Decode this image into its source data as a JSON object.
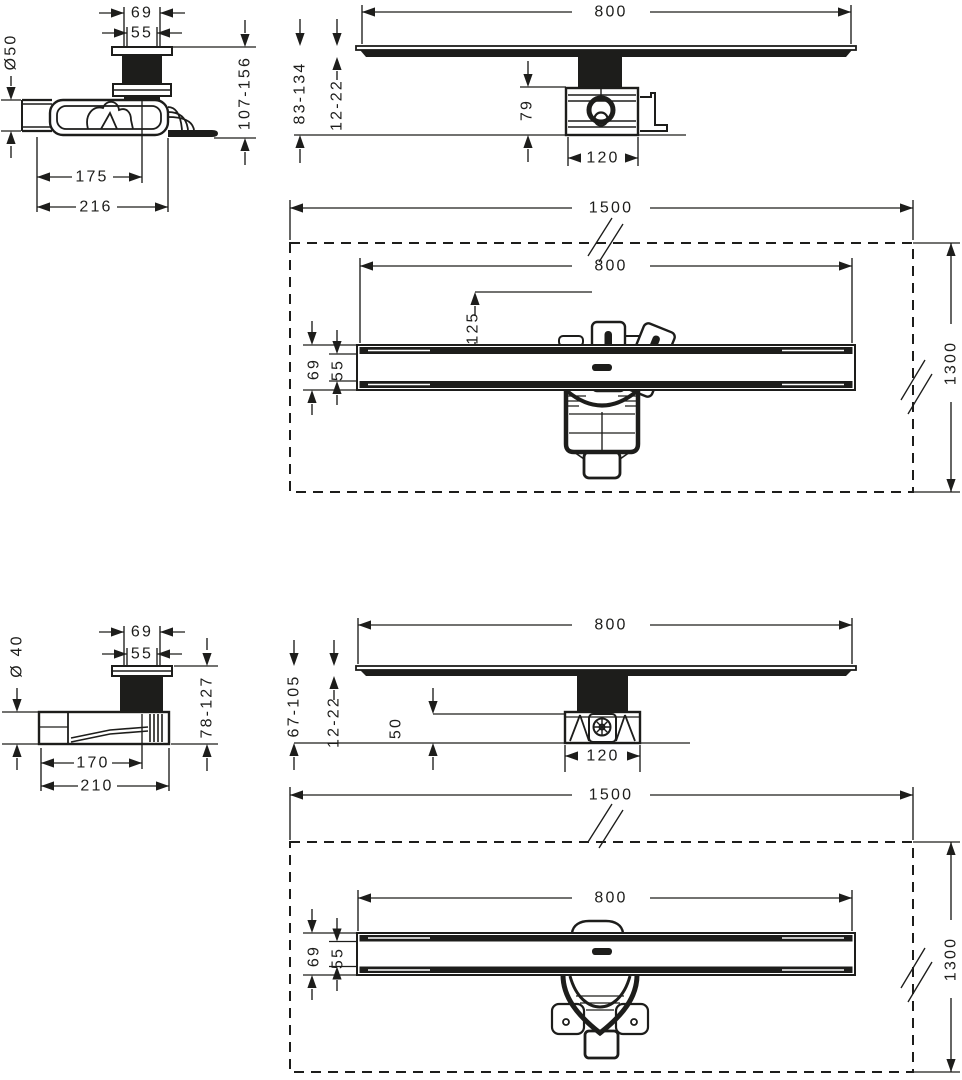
{
  "drawing": {
    "background": "#ffffff",
    "line_color": "#1d1d1b",
    "views": {
      "v1_side": {
        "width_top": "69",
        "width_inner": "55",
        "outlet_diameter": "Ø50",
        "install_height_range": "107-156",
        "outlet_center_distance": "175",
        "total_length": "216"
      },
      "v1_front": {
        "channel_length": "800",
        "install_height_range": "83-134",
        "tile_adjustment": "12-22",
        "trap_depth": "79",
        "trap_width": "120"
      },
      "v1_plan": {
        "area_width": "1500",
        "channel_length": "800",
        "center_offset": "125",
        "channel_width": "69",
        "grate_width": "55",
        "area_depth": "1300"
      },
      "v2_side": {
        "width_top": "69",
        "width_inner": "55",
        "outlet_diameter": "Ø 40",
        "install_height_range": "78-127",
        "outlet_center_distance": "170",
        "total_length": "210"
      },
      "v2_front": {
        "channel_length": "800",
        "install_height_range": "67-105",
        "tile_adjustment": "12-22",
        "trap_depth": "50",
        "trap_width": "120"
      },
      "v2_plan": {
        "area_width": "1500",
        "channel_length": "800",
        "channel_width": "69",
        "grate_width": "55",
        "area_depth": "1300"
      }
    }
  }
}
